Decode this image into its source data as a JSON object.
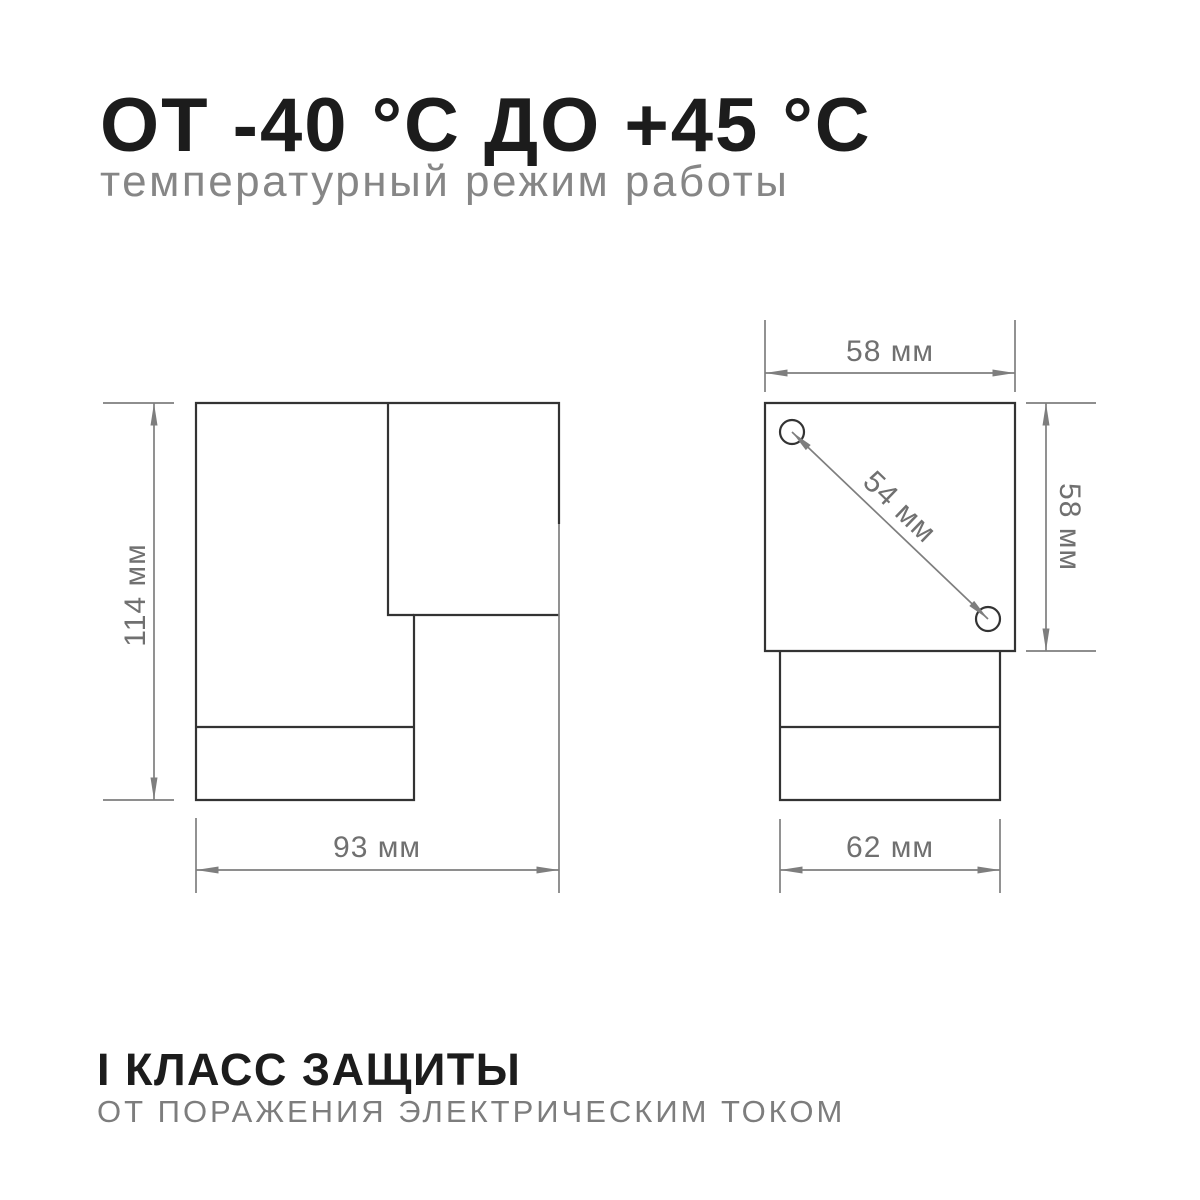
{
  "header": {
    "title": "ОТ -40 °С ДО +45 °С",
    "subtitle": "температурный режим работы"
  },
  "footer": {
    "title": "I КЛАСС ЗАЩИТЫ",
    "subtitle": "ОТ ПОРАЖЕНИЯ ЭЛЕКТРИЧЕСКИМ ТОКОМ"
  },
  "diagram": {
    "side_view": {
      "height_label": "114 мм",
      "width_label": "93 мм"
    },
    "front_view": {
      "width_label": "58 мм",
      "height_label": "58 мм",
      "screw_distance_label": "54 мм",
      "base_width_label": "62 мм"
    },
    "colors": {
      "object_line": "#333333",
      "dimension_line": "#7e7e7e",
      "label_text": "#707070",
      "title_text": "#1c1c1c",
      "subtitle_text": "#868686"
    }
  }
}
